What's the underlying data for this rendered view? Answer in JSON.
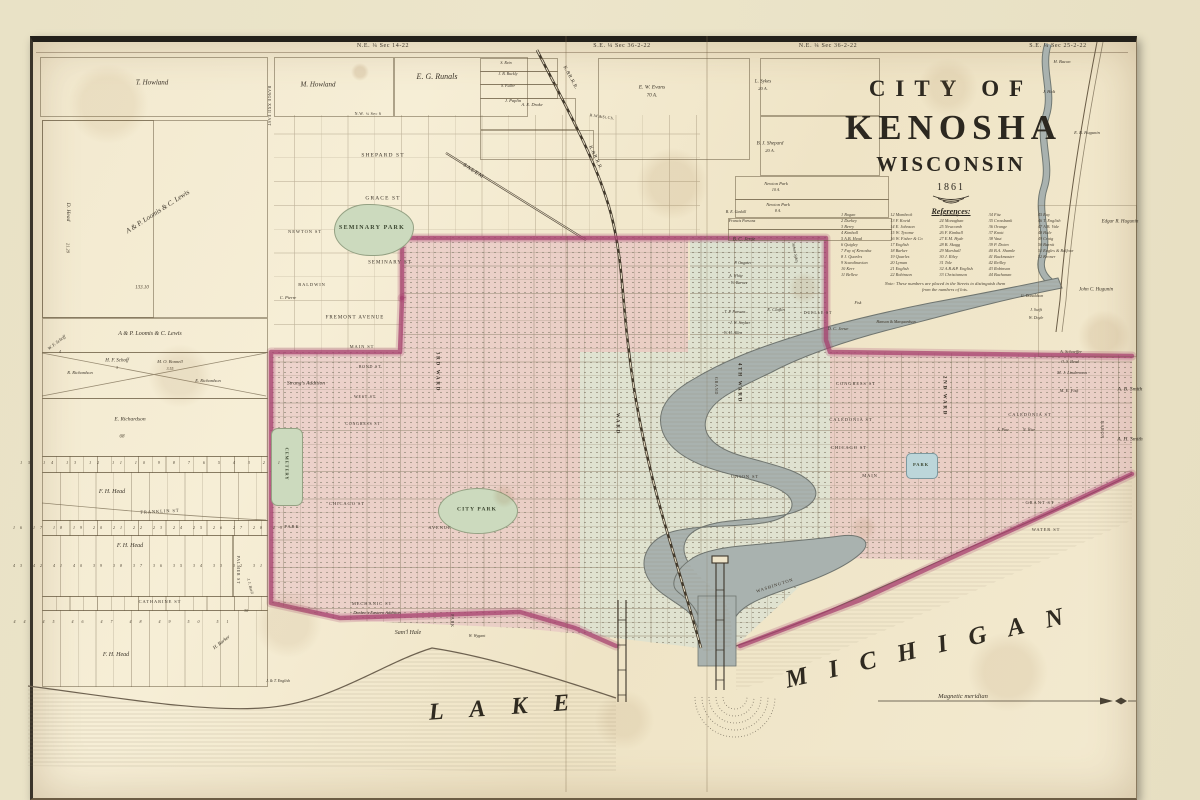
{
  "window": {
    "width": 1200,
    "height": 800
  },
  "colors": {
    "mat": "#e9e2c6",
    "paper": "#f2e9d0",
    "ink": "#3a3328",
    "pink": "#e4b7c1",
    "cyan": "#cfdfd8",
    "magenta": "#a63e6e",
    "green": "#ccdabe",
    "water": "#a9b2af",
    "line": "#8a785c"
  },
  "title": {
    "line1": "CITY OF",
    "line2": "KENOSHA",
    "line3": "WISCONSIN",
    "year": "1861",
    "references_heading": "References:",
    "note": "Note: These numbers are placed in the Streets to distinguish them from the numbers of lots."
  },
  "references": {
    "columns": [
      [
        "1 Bogan",
        "2 Durkey",
        "3 Berry",
        "4 Kimball",
        "5 A.B. Head",
        "6 Quigley",
        "7 Fay of Kenosha",
        "8 J. Quarles",
        "9 Scandinavian",
        "10 Kerr",
        "11 Bellew"
      ],
      [
        "12 Mombeck",
        "13 F. Kovid",
        "14 E. Johnson",
        "15 W. Tyrame",
        "16 W. Fisher & Co",
        "17 English",
        "18 Barker",
        "19 Quarles",
        "20 Lyman",
        "21 English",
        "22 Robinson"
      ],
      [
        "23 Whitney",
        "24 Monaghan",
        "25 Newcomb",
        "26 F. Kimball",
        "27 E.M. Hyde",
        "28 B. Skagg",
        "29 Marshall",
        "30 J. Riley",
        "31 Tole",
        "32 A.B.&P. English",
        "33 Christianson"
      ],
      [
        "34 Fitz",
        "35 Crossbank",
        "36 Orange",
        "37 Knott",
        "38 Vaut",
        "39 P. Doten",
        "40 B.A. Shamle",
        "41 Buckmaster",
        "42 Reilley",
        "43 Robinson",
        "44 Buchanan"
      ],
      [
        "45 Ray",
        "46 T. English",
        "47 A.B. Vale",
        "48 Hale",
        "49 Craig",
        "50 Burnit",
        "51 Eagles & Balfour",
        "52 Kroner"
      ]
    ]
  },
  "map": {
    "labels": [
      {
        "t": "N.E. ¼ Sec 14-22",
        "x": 383,
        "y": 46,
        "s": 6,
        "k": "sec"
      },
      {
        "t": "S.E. ¼ Sec 36-2-22",
        "x": 622,
        "y": 46,
        "s": 6,
        "k": "sec"
      },
      {
        "t": "N.E. ¼ Sec 36-2-22",
        "x": 828,
        "y": 46,
        "s": 6,
        "k": "sec"
      },
      {
        "t": "S.E. ¼ Sec 25-2-22",
        "x": 1058,
        "y": 46,
        "s": 6,
        "k": "sec"
      },
      {
        "t": "RANGE XXII EAST",
        "x": 269,
        "y": 106,
        "s": 4,
        "r": 90,
        "k": "sec"
      },
      {
        "t": "N.W. ¼ Sec 6",
        "x": 368,
        "y": 114,
        "s": 4,
        "k": "sec"
      },
      {
        "t": "T. Howland",
        "x": 152,
        "y": 83,
        "s": 7,
        "k": "n"
      },
      {
        "t": "M. Howland",
        "x": 318,
        "y": 85,
        "s": 7,
        "k": "n"
      },
      {
        "t": "E. G. Runals",
        "x": 437,
        "y": 77,
        "s": 8,
        "k": "n"
      },
      {
        "t": "S. Rein",
        "x": 506,
        "y": 63,
        "s": 4,
        "k": "n"
      },
      {
        "t": "J. B. Buckly",
        "x": 508,
        "y": 74,
        "s": 4,
        "k": "n"
      },
      {
        "t": "S. Fuller",
        "x": 508,
        "y": 86,
        "s": 4,
        "k": "n"
      },
      {
        "t": "J. Paplin",
        "x": 513,
        "y": 101,
        "s": 4.5,
        "k": "n"
      },
      {
        "t": "A. E. Drake",
        "x": 532,
        "y": 105,
        "s": 4.5,
        "k": "n"
      },
      {
        "t": "K.&R.R.R.",
        "x": 570,
        "y": 78,
        "s": 5,
        "r": 62,
        "k": "rr"
      },
      {
        "t": "K.&R.R.R.",
        "x": 595,
        "y": 158,
        "s": 5,
        "r": 65,
        "k": "rr"
      },
      {
        "t": "R.W.&St.Ch.",
        "x": 602,
        "y": 117,
        "s": 4,
        "r": 8,
        "k": "rr"
      },
      {
        "t": "E. W. Evans",
        "x": 652,
        "y": 88,
        "s": 5.5,
        "k": "n"
      },
      {
        "t": "70 A.",
        "x": 652,
        "y": 96,
        "s": 5,
        "k": "n"
      },
      {
        "t": "L. Sykes",
        "x": 763,
        "y": 82,
        "s": 5,
        "k": "n"
      },
      {
        "t": "20 A.",
        "x": 763,
        "y": 89,
        "s": 4.5,
        "k": "n"
      },
      {
        "t": "H. Bacon",
        "x": 1062,
        "y": 62,
        "s": 4.5,
        "k": "n"
      },
      {
        "t": "J. Holt",
        "x": 1049,
        "y": 92,
        "s": 4.5,
        "k": "n"
      },
      {
        "t": "E. B. Hugunin",
        "x": 1087,
        "y": 133,
        "s": 4.5,
        "k": "n"
      },
      {
        "t": "Edgar R. Hugunin",
        "x": 1120,
        "y": 222,
        "s": 5,
        "k": "n"
      },
      {
        "t": "John C. Hugunin",
        "x": 1096,
        "y": 290,
        "s": 5,
        "k": "n"
      },
      {
        "t": "B. J. Shepard",
        "x": 770,
        "y": 144,
        "s": 5,
        "k": "n"
      },
      {
        "t": "20 A.",
        "x": 770,
        "y": 151,
        "s": 4.5,
        "k": "n"
      },
      {
        "t": "Newton Park",
        "x": 776,
        "y": 184,
        "s": 4.5,
        "k": "n"
      },
      {
        "t": "10 A.",
        "x": 776,
        "y": 190,
        "s": 4,
        "k": "n"
      },
      {
        "t": "Newton Park",
        "x": 778,
        "y": 205,
        "s": 4.5,
        "k": "n"
      },
      {
        "t": "8 A.",
        "x": 778,
        "y": 211,
        "s": 4,
        "k": "n"
      },
      {
        "t": "B. E. Gaskill",
        "x": 736,
        "y": 212,
        "s": 4,
        "k": "n"
      },
      {
        "t": "Francis Parsons",
        "x": 742,
        "y": 221,
        "s": 4,
        "k": "n"
      },
      {
        "t": "SALEM",
        "x": 473,
        "y": 172,
        "s": 5.5,
        "r": 33,
        "k": "st"
      },
      {
        "t": "C. Pierre",
        "x": 288,
        "y": 298,
        "s": 4.5,
        "k": "n"
      },
      {
        "t": "A & P. Loomis & C. Lewis",
        "x": 158,
        "y": 212,
        "s": 7,
        "r": -33,
        "k": "n"
      },
      {
        "t": "D. Head",
        "x": 67,
        "y": 212,
        "s": 5.5,
        "r": 90,
        "k": "n"
      },
      {
        "t": "21.29",
        "x": 67,
        "y": 248,
        "s": 4.5,
        "r": 90,
        "k": "num"
      },
      {
        "t": "133.10",
        "x": 142,
        "y": 288,
        "s": 5,
        "k": "num"
      },
      {
        "t": "A & P. Loomis & C. Lewis",
        "x": 150,
        "y": 334,
        "s": 6,
        "k": "n"
      },
      {
        "t": "W. F. Schoff",
        "x": 57,
        "y": 343,
        "s": 4.5,
        "r": -38,
        "k": "n"
      },
      {
        "t": "4",
        "x": 60,
        "y": 352,
        "s": 4,
        "k": "num"
      },
      {
        "t": "H. F. Schoff",
        "x": 117,
        "y": 361,
        "s": 5,
        "k": "n"
      },
      {
        "t": "3",
        "x": 117,
        "y": 368,
        "s": 4,
        "k": "num"
      },
      {
        "t": "M. O. Bonnell",
        "x": 170,
        "y": 362,
        "s": 4.5,
        "k": "n"
      },
      {
        "t": "3.55",
        "x": 170,
        "y": 369,
        "s": 4,
        "k": "num"
      },
      {
        "t": "R. Richardson",
        "x": 80,
        "y": 373,
        "s": 4.5,
        "k": "n"
      },
      {
        "t": "E. Richardson",
        "x": 208,
        "y": 381,
        "s": 4.5,
        "k": "n"
      },
      {
        "t": "E. Richardson",
        "x": 130,
        "y": 420,
        "s": 5.5,
        "k": "n"
      },
      {
        "t": "68",
        "x": 122,
        "y": 437,
        "s": 5,
        "k": "num"
      },
      {
        "t": "15 14 13 12 11 10 9 8 7 6 5 4 3 2 1",
        "x": 153,
        "y": 463,
        "s": 4,
        "ls": 6,
        "k": "num"
      },
      {
        "t": "F. H. Head",
        "x": 112,
        "y": 492,
        "s": 6,
        "k": "n"
      },
      {
        "t": "FRANKLIN ST",
        "x": 160,
        "y": 512,
        "s": 4.5,
        "r": -3,
        "k": "st"
      },
      {
        "t": "16 17 18 19 20 21 22 23 24 25 26 27 28 29",
        "x": 150,
        "y": 528,
        "s": 4,
        "ls": 5,
        "k": "num"
      },
      {
        "t": "F. H. Head",
        "x": 130,
        "y": 546,
        "s": 6,
        "k": "n"
      },
      {
        "t": "43 42 41 40 39 38 37 36 35 34 33 32 31",
        "x": 140,
        "y": 566,
        "s": 4,
        "ls": 5,
        "k": "num"
      },
      {
        "t": "CATHARINE ST",
        "x": 160,
        "y": 602,
        "s": 4.5,
        "k": "st"
      },
      {
        "t": "PALMER ST",
        "x": 238,
        "y": 570,
        "s": 4,
        "r": 90,
        "k": "st"
      },
      {
        "t": "J. J. Buell",
        "x": 250,
        "y": 586,
        "s": 4,
        "r": 75,
        "k": "n"
      },
      {
        "t": "30",
        "x": 246,
        "y": 611,
        "s": 4,
        "k": "num"
      },
      {
        "t": "44 45 46 47 48 49 50 51",
        "x": 125,
        "y": 622,
        "s": 4,
        "ls": 8,
        "k": "num"
      },
      {
        "t": "F. H. Head",
        "x": 116,
        "y": 655,
        "s": 6,
        "k": "n"
      },
      {
        "t": "H. Barker",
        "x": 222,
        "y": 643,
        "s": 5,
        "r": -38,
        "k": "n"
      },
      {
        "t": "J. & T. English",
        "x": 278,
        "y": 681,
        "s": 4,
        "k": "n"
      },
      {
        "t": "SHEPARD ST",
        "x": 383,
        "y": 156,
        "s": 5.5,
        "k": "st"
      },
      {
        "t": "GRACE ST",
        "x": 383,
        "y": 199,
        "s": 5.5,
        "k": "st"
      },
      {
        "t": "SEMINARY PARK",
        "x": 372,
        "y": 228,
        "s": 6,
        "k": "pk"
      },
      {
        "t": "NEWTON ST",
        "x": 305,
        "y": 232,
        "s": 4.5,
        "k": "st"
      },
      {
        "t": "SEMINARY ST",
        "x": 390,
        "y": 263,
        "s": 5,
        "k": "st"
      },
      {
        "t": "BALDWIN",
        "x": 312,
        "y": 285,
        "s": 4.5,
        "k": "st"
      },
      {
        "t": "FREMONT AVENUE",
        "x": 355,
        "y": 318,
        "s": 5,
        "k": "st"
      },
      {
        "t": "Strang's Addition",
        "x": 306,
        "y": 384,
        "s": 5.5,
        "k": "n"
      },
      {
        "t": "CEMETERY",
        "x": 286,
        "y": 464,
        "s": 4.5,
        "r": 90,
        "k": "pk"
      },
      {
        "t": "MAIN ST",
        "x": 362,
        "y": 347,
        "s": 4.5,
        "k": "st"
      },
      {
        "t": "BOND ST",
        "x": 370,
        "y": 367,
        "s": 4,
        "k": "st"
      },
      {
        "t": "WEST ST",
        "x": 365,
        "y": 397,
        "s": 4,
        "k": "st"
      },
      {
        "t": "CONGRESS ST",
        "x": 363,
        "y": 424,
        "s": 4,
        "k": "st"
      },
      {
        "t": "CHICAGO ST",
        "x": 347,
        "y": 504,
        "s": 4.5,
        "k": "st"
      },
      {
        "t": "PARK",
        "x": 292,
        "y": 527,
        "s": 4.5,
        "k": "st"
      },
      {
        "t": "AVENUE",
        "x": 440,
        "y": 528,
        "s": 4.5,
        "k": "st"
      },
      {
        "t": "3RD WARD",
        "x": 437,
        "y": 372,
        "s": 5,
        "r": 90,
        "k": "ward"
      },
      {
        "t": "CITY PARK",
        "x": 477,
        "y": 510,
        "s": 5.5,
        "k": "pk"
      },
      {
        "t": "WARD",
        "x": 617,
        "y": 424,
        "s": 5,
        "r": 90,
        "k": "ward"
      },
      {
        "t": "GRAND",
        "x": 716,
        "y": 386,
        "s": 4,
        "r": 90,
        "k": "st"
      },
      {
        "t": "4TH WARD",
        "x": 739,
        "y": 383,
        "s": 5,
        "r": 90,
        "k": "ward"
      },
      {
        "t": "UNION ST",
        "x": 745,
        "y": 477,
        "s": 4.5,
        "k": "st"
      },
      {
        "t": "WASHINGTON",
        "x": 775,
        "y": 586,
        "s": 4.5,
        "r": -18,
        "k": "st"
      },
      {
        "t": "B. C. Jerue",
        "x": 744,
        "y": 240,
        "s": 5,
        "k": "n"
      },
      {
        "t": "Simon Sykes",
        "x": 795,
        "y": 253,
        "s": 4,
        "r": 78,
        "k": "n"
      },
      {
        "t": "P. Gagnier",
        "x": 743,
        "y": 263,
        "s": 4,
        "k": "n"
      },
      {
        "t": "A. White",
        "x": 736,
        "y": 276,
        "s": 4,
        "k": "n"
      },
      {
        "t": "W. Barnes",
        "x": 739,
        "y": 283,
        "s": 4,
        "k": "n"
      },
      {
        "t": "T. P. Parsons",
        "x": 735,
        "y": 312,
        "s": 4,
        "k": "n"
      },
      {
        "t": "E. Claflin",
        "x": 776,
        "y": 310,
        "s": 4.5,
        "k": "n"
      },
      {
        "t": "DUELLE ST",
        "x": 818,
        "y": 313,
        "s": 4,
        "k": "st"
      },
      {
        "t": "J. W. Stryker",
        "x": 740,
        "y": 323,
        "s": 4,
        "k": "n"
      },
      {
        "t": "W. H. Allen",
        "x": 733,
        "y": 333,
        "s": 4,
        "k": "n"
      },
      {
        "t": "D. C. Jerue",
        "x": 838,
        "y": 329,
        "s": 4.5,
        "k": "n"
      },
      {
        "t": "Fisk",
        "x": 858,
        "y": 303,
        "s": 4,
        "k": "n"
      },
      {
        "t": "Hanson & Marquardson",
        "x": 896,
        "y": 322,
        "s": 4,
        "k": "n"
      },
      {
        "t": "CONGRESS ST",
        "x": 856,
        "y": 384,
        "s": 4.5,
        "k": "st"
      },
      {
        "t": "CALEDONIA ST",
        "x": 851,
        "y": 420,
        "s": 4.5,
        "k": "st"
      },
      {
        "t": "CHICAGO ST",
        "x": 849,
        "y": 448,
        "s": 4.5,
        "k": "st"
      },
      {
        "t": "MAIN",
        "x": 870,
        "y": 476,
        "s": 4.5,
        "k": "st"
      },
      {
        "t": "2ND WARD",
        "x": 944,
        "y": 396,
        "s": 5,
        "r": 90,
        "k": "ward"
      },
      {
        "t": "A. Schaeffer",
        "x": 1071,
        "y": 352,
        "s": 4.5,
        "k": "n"
      },
      {
        "t": "O. S. Head",
        "x": 1070,
        "y": 362,
        "s": 4,
        "k": "n"
      },
      {
        "t": "M. J. Linderman",
        "x": 1072,
        "y": 373,
        "s": 4.5,
        "k": "n"
      },
      {
        "t": "M. E. Fisk",
        "x": 1069,
        "y": 391,
        "s": 4.5,
        "k": "n"
      },
      {
        "t": "A. B. Smith",
        "x": 1130,
        "y": 390,
        "s": 5.5,
        "k": "n"
      },
      {
        "t": "A. H. Smith",
        "x": 1130,
        "y": 440,
        "s": 5.5,
        "k": "n"
      },
      {
        "t": "CALEDONIA ST",
        "x": 1030,
        "y": 415,
        "s": 4.5,
        "k": "st"
      },
      {
        "t": "A. Pine",
        "x": 1003,
        "y": 430,
        "s": 4,
        "k": "n"
      },
      {
        "t": "N. Wier",
        "x": 1029,
        "y": 430,
        "s": 4,
        "k": "n"
      },
      {
        "t": "BARON",
        "x": 1102,
        "y": 430,
        "s": 4,
        "r": 90,
        "k": "st"
      },
      {
        "t": "GRANT ST",
        "x": 1040,
        "y": 503,
        "s": 4.5,
        "k": "st"
      },
      {
        "t": "WATER ST",
        "x": 1046,
        "y": 530,
        "s": 4.5,
        "k": "st"
      },
      {
        "t": "PARK",
        "x": 921,
        "y": 465,
        "s": 4.5,
        "k": "pk"
      },
      {
        "t": "G. Donaldson",
        "x": 1032,
        "y": 296,
        "s": 4,
        "k": "n"
      },
      {
        "t": "J. Swift",
        "x": 1036,
        "y": 310,
        "s": 4,
        "k": "n"
      },
      {
        "t": "W. Doyle",
        "x": 1036,
        "y": 318,
        "s": 4,
        "k": "n"
      },
      {
        "t": "MECHANIC ST",
        "x": 372,
        "y": 604,
        "s": 4.5,
        "k": "st"
      },
      {
        "t": "Durkee's Eastern Addition",
        "x": 377,
        "y": 613,
        "s": 4.5,
        "k": "n"
      },
      {
        "t": "Sam'l Hale",
        "x": 408,
        "y": 633,
        "s": 6,
        "k": "n"
      },
      {
        "t": "W. Wygant",
        "x": 477,
        "y": 636,
        "s": 4,
        "k": "n"
      },
      {
        "t": "PARK",
        "x": 452,
        "y": 621,
        "s": 4,
        "r": 90,
        "k": "st"
      },
      {
        "t": "LAKE",
        "x": 512,
        "y": 707,
        "s": 24,
        "ls": 26,
        "r": -4,
        "k": "lake"
      },
      {
        "t": "MICHIGAN",
        "x": 935,
        "y": 646,
        "s": 25,
        "ls": 22,
        "r": -13,
        "k": "lake"
      },
      {
        "t": "Magnetic meridian",
        "x": 963,
        "y": 697,
        "s": 6.5,
        "k": "n"
      }
    ],
    "parcels": [
      {
        "x": 40,
        "y": 57,
        "w": 226,
        "h": 58
      },
      {
        "x": 274,
        "y": 57,
        "w": 118,
        "h": 58
      },
      {
        "x": 394,
        "y": 57,
        "w": 132,
        "h": 58
      },
      {
        "x": 480,
        "y": 58,
        "w": 76,
        "h": 12
      },
      {
        "x": 480,
        "y": 71,
        "w": 76,
        "h": 12
      },
      {
        "x": 480,
        "y": 84,
        "w": 76,
        "h": 13
      },
      {
        "x": 480,
        "y": 98,
        "w": 94,
        "h": 30
      },
      {
        "x": 480,
        "y": 130,
        "w": 112,
        "h": 28
      },
      {
        "x": 598,
        "y": 58,
        "w": 150,
        "h": 100
      },
      {
        "x": 760,
        "y": 58,
        "w": 118,
        "h": 56
      },
      {
        "x": 760,
        "y": 116,
        "w": 118,
        "h": 58
      },
      {
        "x": 735,
        "y": 176,
        "w": 152,
        "h": 22
      },
      {
        "x": 735,
        "y": 199,
        "w": 152,
        "h": 17
      },
      {
        "x": 728,
        "y": 218,
        "w": 162,
        "h": 10
      },
      {
        "x": 728,
        "y": 229,
        "w": 162,
        "h": 10
      },
      {
        "x": 42,
        "y": 120,
        "w": 224,
        "h": 196
      },
      {
        "x": 42,
        "y": 120,
        "w": 110,
        "h": 196
      },
      {
        "x": 42,
        "y": 318,
        "w": 224,
        "h": 33
      },
      {
        "x": 42,
        "y": 352,
        "w": 224,
        "h": 45
      },
      {
        "x": 42,
        "y": 398,
        "w": 224,
        "h": 57
      },
      {
        "x": 42,
        "y": 456,
        "w": 224,
        "h": 15,
        "c": "lots"
      },
      {
        "x": 42,
        "y": 472,
        "w": 224,
        "h": 47,
        "c": "lotsTall"
      },
      {
        "x": 42,
        "y": 520,
        "w": 224,
        "h": 14,
        "c": "lots"
      },
      {
        "x": 42,
        "y": 535,
        "w": 190,
        "h": 60,
        "c": "lotsTall"
      },
      {
        "x": 232,
        "y": 535,
        "w": 34,
        "h": 60
      },
      {
        "x": 42,
        "y": 596,
        "w": 224,
        "h": 13,
        "c": "lots"
      },
      {
        "x": 42,
        "y": 610,
        "w": 224,
        "h": 75,
        "c": "lotsTall"
      },
      {
        "x": 1038,
        "y": 205,
        "w": 97,
        "h": 150,
        "c": "faint"
      }
    ]
  }
}
